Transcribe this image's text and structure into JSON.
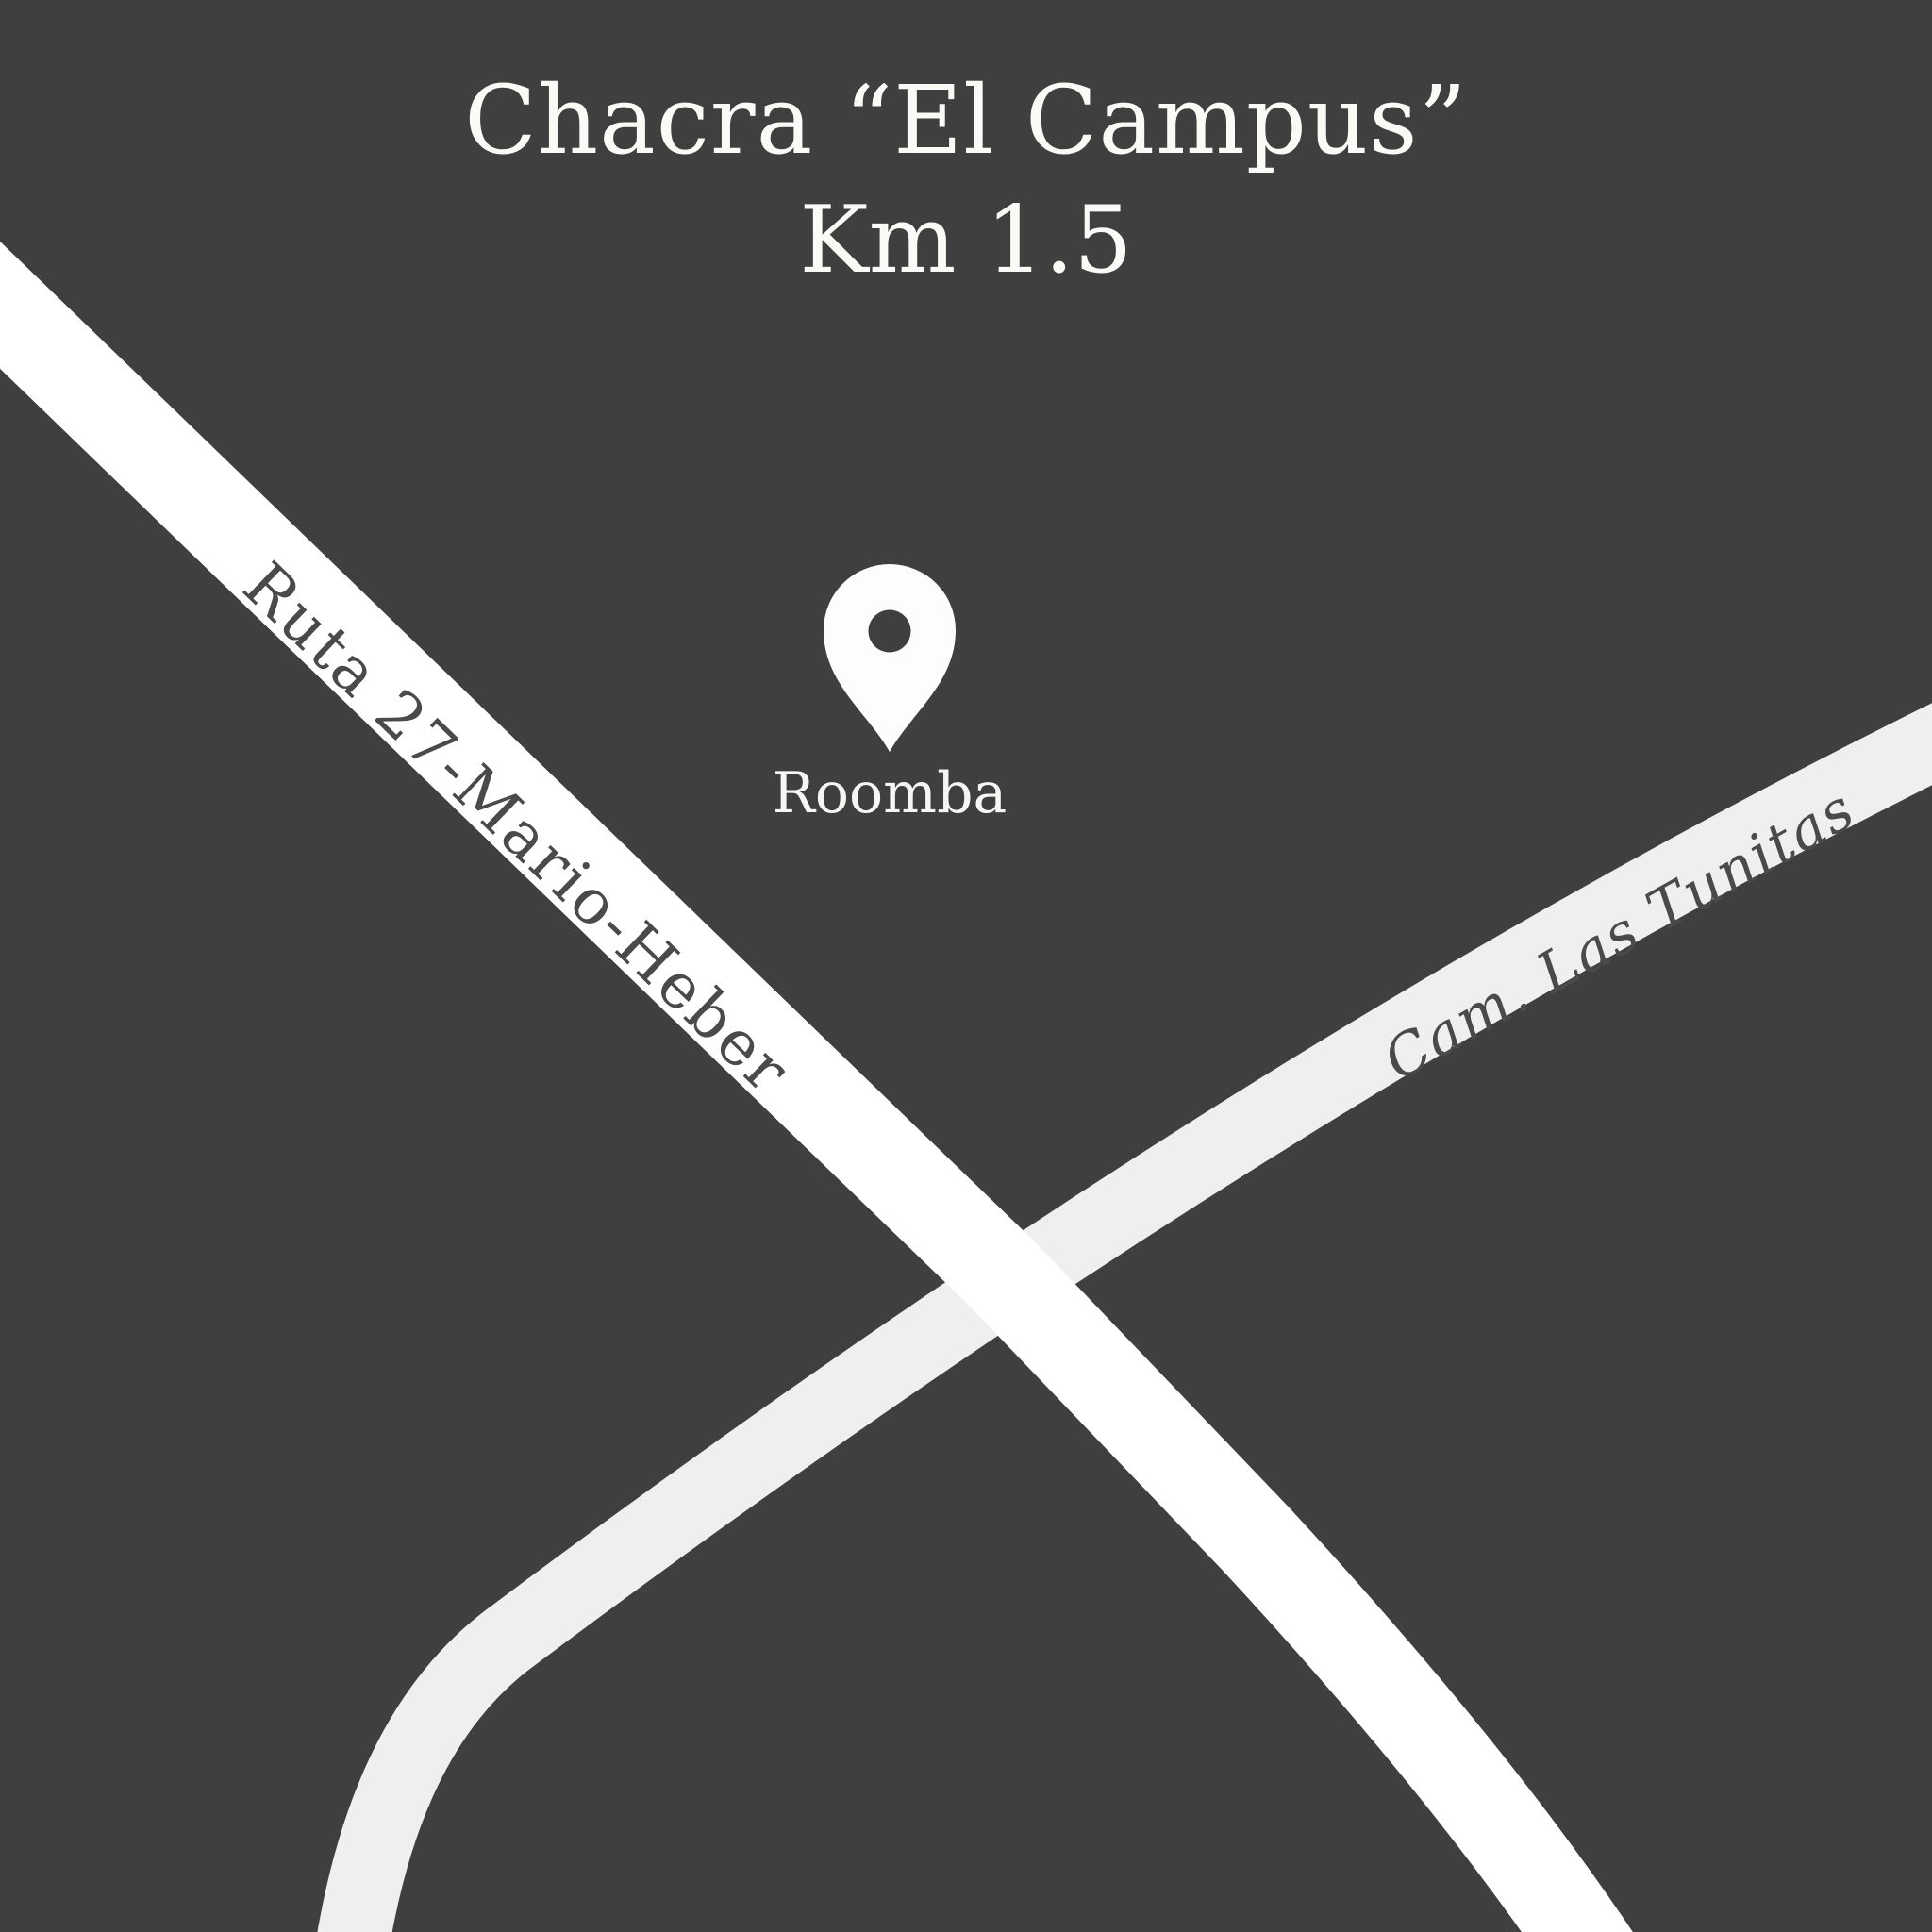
{
  "title": {
    "line1": "Chacra “El Campus”",
    "line2": "Km 1.5"
  },
  "marker": {
    "label": "Roomba",
    "icon": "map-pin-icon"
  },
  "roads": [
    {
      "id": "ruta-27",
      "name": "Ruta 27-Mario-Heber",
      "style": "major"
    },
    {
      "id": "cam-las-tunitas",
      "name": "Cam. Las Tunitas",
      "style": "minor"
    }
  ],
  "colors": {
    "bg": "#3f3f3f",
    "road-major": "#ffffff",
    "road-minor": "#efefef",
    "ink": "#fafaf7",
    "road-label-ink": "#4a4a4a"
  }
}
